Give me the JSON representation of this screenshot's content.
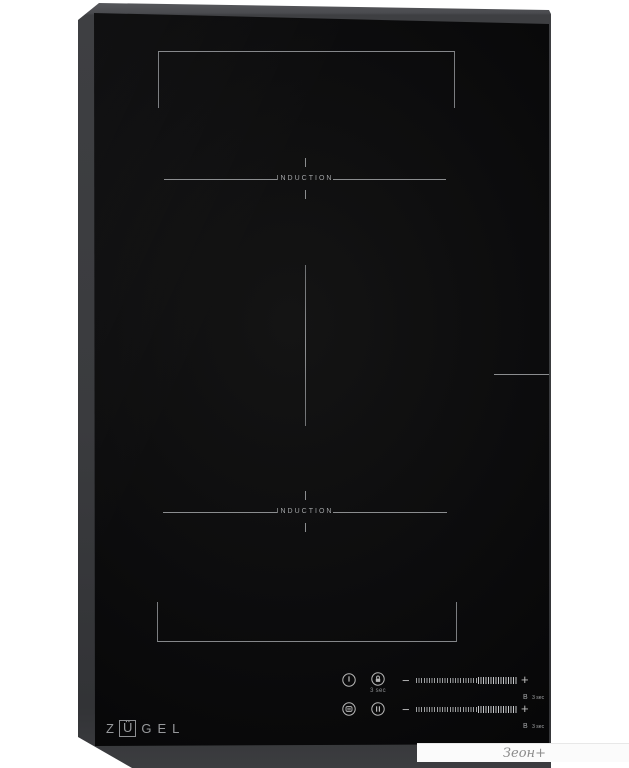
{
  "brand": {
    "letter_z": "Z",
    "letter_u_boxed": "Ü",
    "letters_gel": "GEL"
  },
  "zones": {
    "top": {
      "label": "INDUCTION"
    },
    "bottom": {
      "label": "INDUCTION"
    }
  },
  "control_panel": {
    "lock_hint": "3 sec",
    "sliders": [
      {
        "minus": "−",
        "plus": "+",
        "boost": "B",
        "boost_hint": "3 sec"
      },
      {
        "minus": "−",
        "plus": "+",
        "boost": "B",
        "boost_hint": "3 sec"
      }
    ]
  },
  "watermark": {
    "text": "Зеон+"
  },
  "colors": {
    "background": "#ffffff",
    "frame_grey": "#47484b",
    "glass_black": "#0c0c0d",
    "marking_grey": "#8b8d8f",
    "icon_grey": "#b8b8b8",
    "watermark_text": "#8b8b8b"
  }
}
